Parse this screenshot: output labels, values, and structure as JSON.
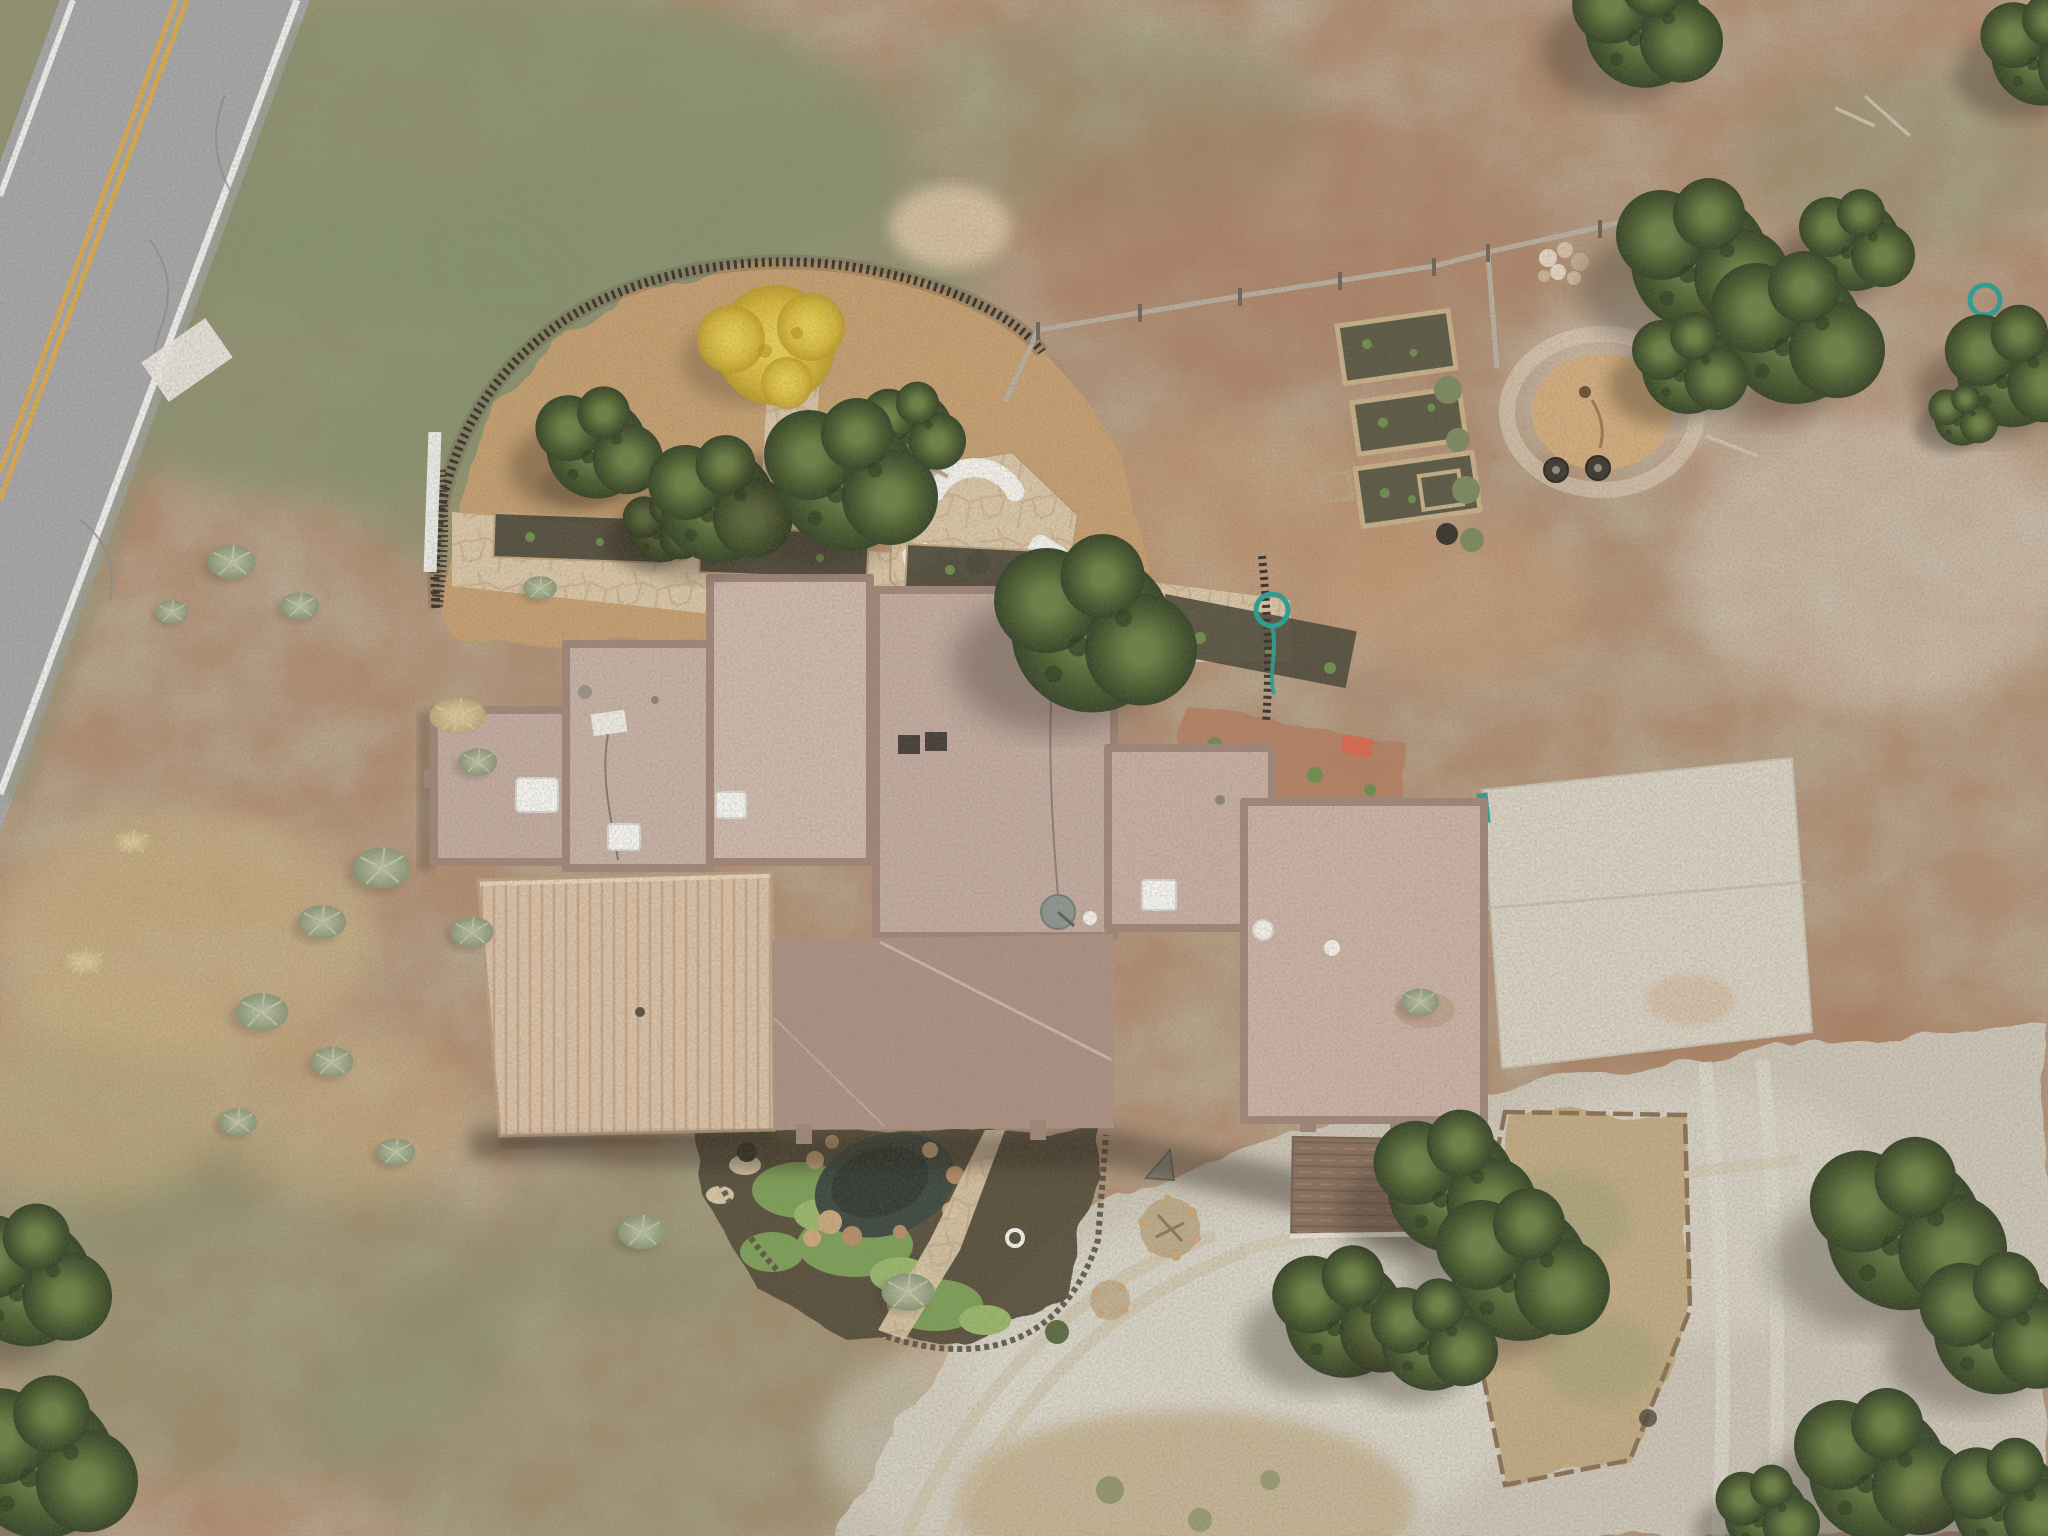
{
  "scene": {
    "type": "aerial-drone-photo",
    "subject": "Overhead view of a flat-roofed adobe-style home on high-desert land, with a stick-fenced backyard, fire-pit patio, raised garden beds, gravel drive, concrete pad and a two-lane road crossing the upper-left corner",
    "no_visible_text": true
  },
  "palette": {
    "dirt_base": "#b08a6e",
    "dirt_red": "#a8765a",
    "dirt_light": "#c49a74",
    "dust_pale": "#d9c4a4",
    "scrub_green": "#87926f",
    "grass_dry": "#c9b184",
    "gravel": "#cdc8ba",
    "gravel_light": "#dcd8cd",
    "concrete": "#d7d1c3",
    "road_asphalt": "#a6a6a8",
    "road_line_yellow": "#d9a94e",
    "road_line_white": "#ededea",
    "roof_tan": "#c2aba0",
    "roof_tan_light": "#cdb8ac",
    "roof_parapet": "#a1877a",
    "roof_metal": "#d9c0a6",
    "roof_metal_rib": "#bfa285",
    "roof_connector": "#ac9284",
    "porch_shingle": "#8a7160",
    "flagstone": "#d8c5a7",
    "flagstone_gap": "#b99c78",
    "mulch_yard": "#c6a072",
    "bed_dark": "#4e4a3c",
    "fence_dark": "#3b342b",
    "fence_wood": "#b7b0a2",
    "timber": "#8a7257",
    "tree_green": "#4a5c31",
    "tree_yellow": "#d5b83c",
    "sage": "#9aa488",
    "pond": "#3e4a42",
    "rock": "#c9a87e",
    "groundcover": "#7da05a",
    "furniture_white": "#f2f1ec",
    "firepit_dark": "#423c34",
    "hose_teal": "#2aa198",
    "mat_coral": "#d96a50",
    "shadow": "#2d261e"
  },
  "objects": [
    "paved-road",
    "double-yellow-centerline",
    "white-edge-lines",
    "coyote-stick-fence",
    "wood-rail-fence",
    "backyard-mulch",
    "yellow-foliage-tree",
    "juniper-trees",
    "sage-bushes",
    "fire-pit-patio",
    "white-patio-furniture",
    "fire-pit",
    "flagstone-patio",
    "planting-beds",
    "raised-garden-beds",
    "rock-pile",
    "woodchip-mound",
    "tires",
    "garden-hoses",
    "flat-roof-house",
    "skylights",
    "satellite-dish",
    "roof-vents",
    "metal-garage-roof",
    "shingled-porch-roof",
    "pond-garden",
    "flagstone-path",
    "concrete-pad",
    "gravel-driveway",
    "driveway-island",
    "wheel-tracks"
  ]
}
